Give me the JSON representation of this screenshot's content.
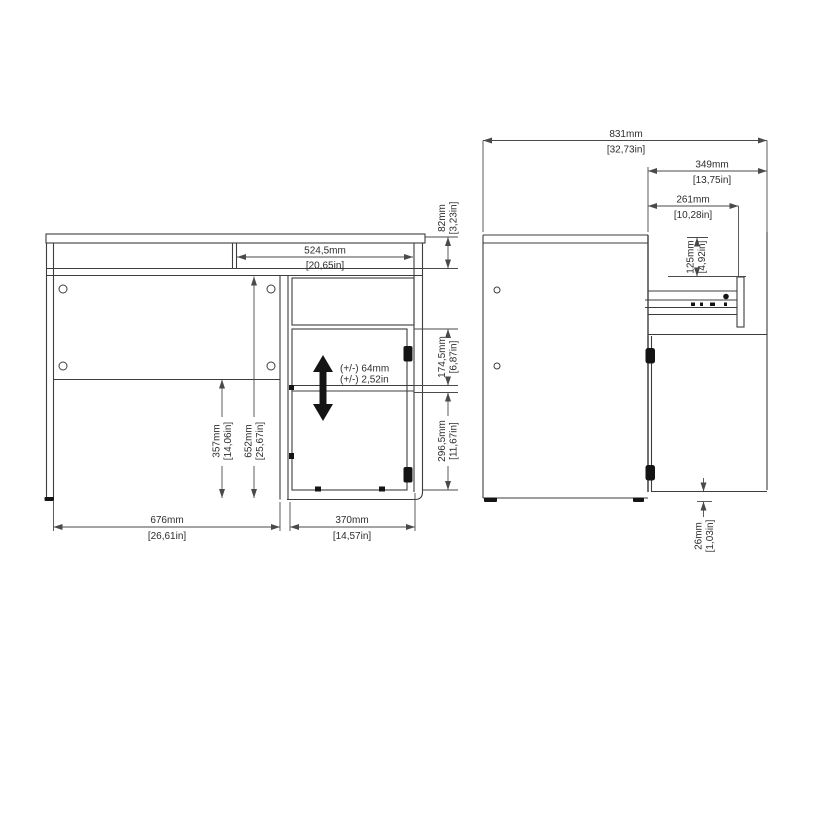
{
  "drawing": {
    "type": "furniture assembly dimension drawing",
    "subject": "desk with drawer and door pedestal, front view and side view (drawer open)"
  },
  "colors": {
    "background": "#ffffff",
    "line": "#3d3d3d",
    "dimension_line": "#4a4a4a",
    "text": "#2d2d2d",
    "solid_fill": "#141414"
  },
  "front_view": {
    "dims": {
      "apron_width": {
        "mm": "524,5mm",
        "inch": "[20,65in]"
      },
      "desktop_height": {
        "mm": "82mm",
        "inch": "[3,23in]"
      },
      "drawer_opening_height": {
        "mm": "174,5mm",
        "inch": "[6,87in]"
      },
      "door_opening_height": {
        "mm": "296,5mm",
        "inch": "[11,67in]"
      },
      "knee_space_height": {
        "mm": "652mm",
        "inch": "[25,67in]"
      },
      "back_panel_to_floor": {
        "mm": "357mm",
        "inch": "[14,06in]"
      },
      "knee_space_width": {
        "mm": "676mm",
        "inch": "[26,61in]"
      },
      "pedestal_width": {
        "mm": "370mm",
        "inch": "[14,57in]"
      },
      "shelf_adjustment": {
        "mm": "(+/-) 64mm",
        "inch": "(+/-) 2,52in"
      }
    }
  },
  "side_view": {
    "dims": {
      "depth_with_drawer_open": {
        "mm": "831mm",
        "inch": "[32,73in]"
      },
      "drawer_extension": {
        "mm": "349mm",
        "inch": "[13,75in]"
      },
      "drawer_depth": {
        "mm": "261mm",
        "inch": "[10,28in]"
      },
      "drawer_front_height": {
        "mm": "125mm",
        "inch": "[4,92in]"
      },
      "door_floor_gap": {
        "mm": "26mm",
        "inch": "[1,03in]"
      }
    }
  }
}
